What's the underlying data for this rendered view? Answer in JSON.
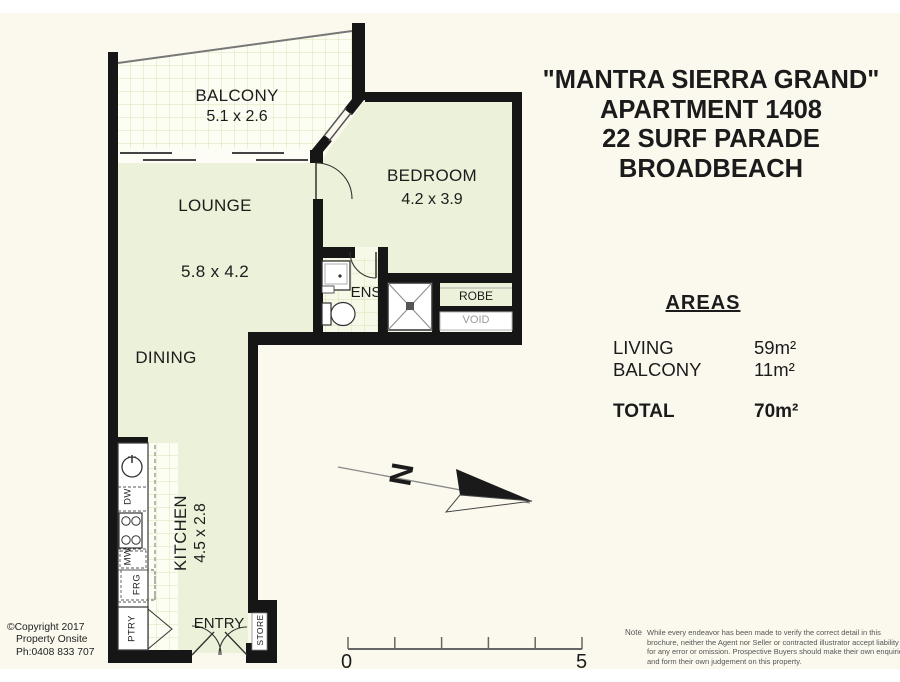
{
  "header": {
    "line1": "\"MANTRA SIERRA GRAND\"",
    "line2": "APARTMENT 1408",
    "line3": "22 SURF PARADE",
    "line4": "BROADBEACH"
  },
  "plan": {
    "rooms": {
      "balcony": {
        "label": "BALCONY",
        "dims": "5.1 x 2.6"
      },
      "lounge": {
        "label": "LOUNGE",
        "dims": "5.8 x 4.2"
      },
      "dining": {
        "label": "DINING"
      },
      "bedroom": {
        "label": "BEDROOM",
        "dims": "4.2 x 3.9"
      },
      "kitchen": {
        "label": "KITCHEN",
        "dims": "4.5 x 2.8"
      },
      "ens": {
        "label": "ENS"
      },
      "robe": {
        "label": "ROBE"
      },
      "void": {
        "label": "VOID"
      },
      "entry": {
        "label": "ENTRY"
      },
      "store": {
        "label": "STORE"
      },
      "pantry": {
        "label": "PTRY"
      }
    },
    "appliances": {
      "dishwasher": "DW",
      "microwave": "MW",
      "fridge": "FRG"
    },
    "compass_label": "N",
    "scale": {
      "start": "0",
      "end": "5"
    }
  },
  "areas": {
    "heading": "AREAS",
    "rows": [
      {
        "label": "LIVING",
        "value": "59m²"
      },
      {
        "label": "BALCONY",
        "value": "11m²"
      }
    ],
    "total": {
      "label": "TOTAL",
      "value": "70m²"
    }
  },
  "credit": {
    "line1": "©Copyright 2017",
    "line2": "Property Onsite",
    "line3": "Ph:0408 833 707"
  },
  "note": {
    "label": "Note",
    "text": "While every endeavor has been made to verify the correct detail in this brochure, neither the Agent nor Seller or contracted illustrator accept liability for any error or omission. Prospective Buyers should make their own enquiries and form their own judgement on this property."
  },
  "colors": {
    "wall": "#161616",
    "room_fill": "#ecf1d9",
    "tile_fill": "#fcfdf3",
    "tile_line": "#dce2b4",
    "background": "#fbf9ee"
  }
}
